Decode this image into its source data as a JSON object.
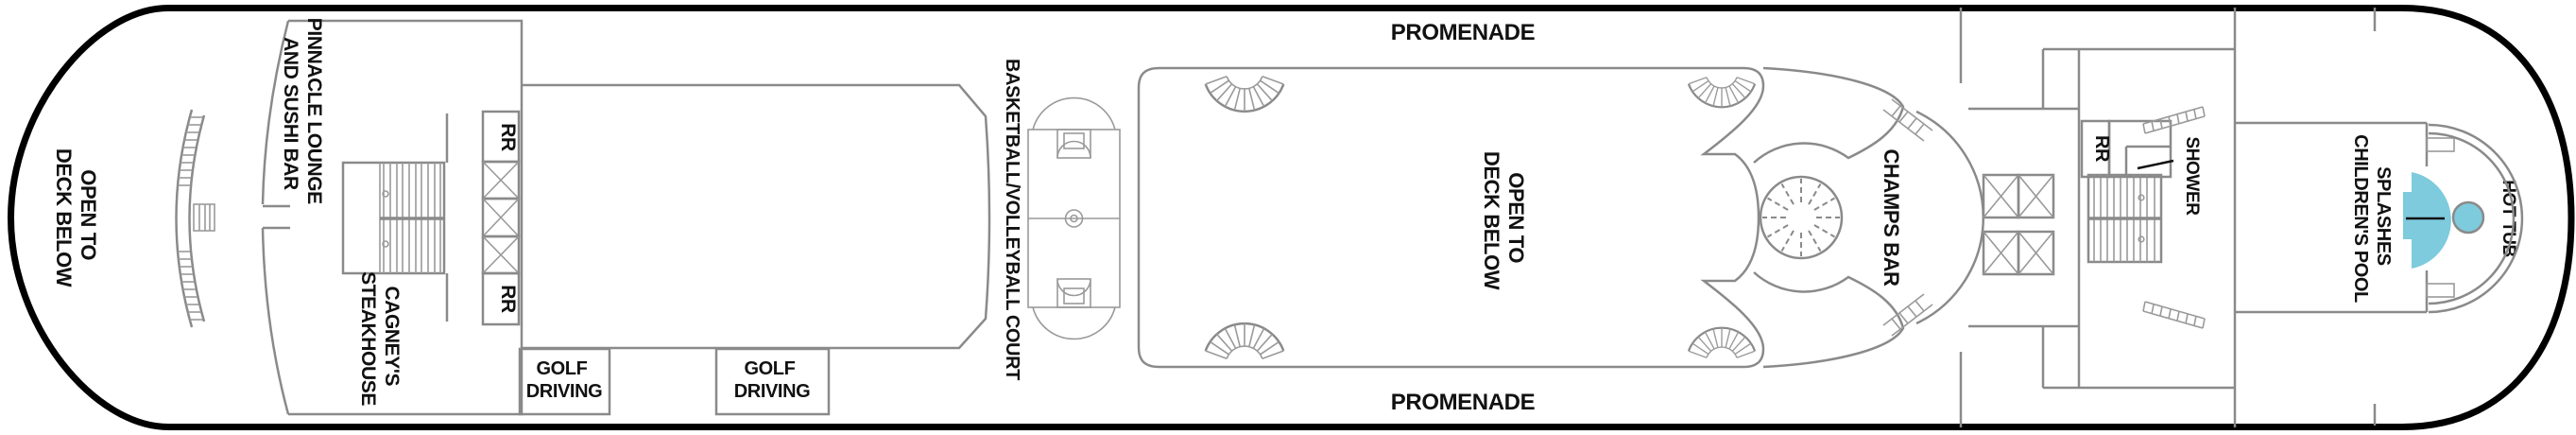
{
  "plan": {
    "title": "Cruise ship deck plan",
    "labels": {
      "bow_open": {
        "l1": "OPEN TO",
        "l2": "DECK BELOW"
      },
      "pinnacle": {
        "l1": "PINNACLE LOUNGE",
        "l2": "AND SUSHI BAR"
      },
      "cagneys": {
        "l1": "CAGNEY'S",
        "l2": "STEAKHOUSE"
      },
      "rr_forward_top": "RR",
      "rr_forward_bottom": "RR",
      "golf_forward": {
        "l1": "GOLF",
        "l2": "DRIVING"
      },
      "golf_aft": {
        "l1": "GOLF",
        "l2": "DRIVING"
      },
      "basketball": "BASKETBALL/VOLLEYBALL COURT",
      "promenade_top": "PROMENADE",
      "promenade_bottom": "PROMENADE",
      "center_open": {
        "l1": "OPEN TO",
        "l2": "DECK BELOW"
      },
      "champs": "CHAMPS BAR",
      "rr_aft": "RR",
      "shower": "SHOWER",
      "splashes": {
        "l1": "SPLASHES",
        "l2": "CHILDREN'S POOL"
      },
      "hot_tub": "HOT TUB"
    },
    "colors": {
      "pool_fill": "#7dcbdd",
      "pool_stroke": "#3f96ad",
      "wall_gray": "#8a8a8a",
      "hull_black": "#000000",
      "text_black": "#111111"
    }
  }
}
